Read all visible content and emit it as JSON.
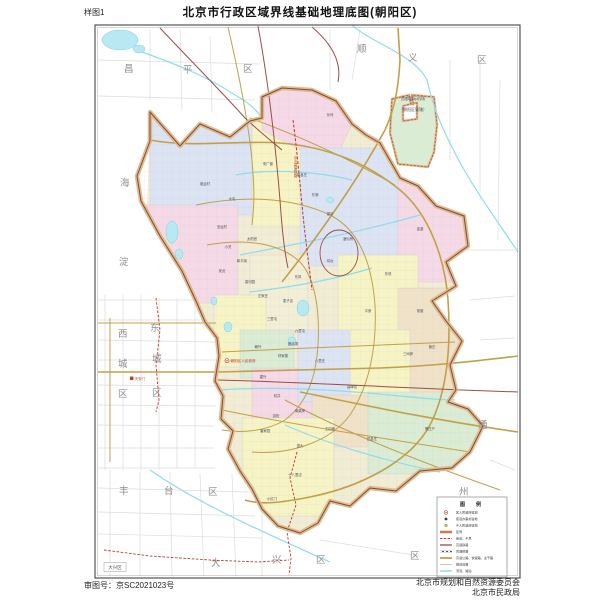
{
  "header": {
    "corner_label": "样图1",
    "title": "北京市行政区域界线基础地理底图(朝阳区)"
  },
  "footer": {
    "approval_number": "审图号：京SC2021023号",
    "credit_line1": "北京市规划和自然资源委员会",
    "credit_line2": "北京市民政局"
  },
  "colors": {
    "boundary_band": "#dbb98c",
    "boundary_line": "#8a4632",
    "district_red": "#c0392b",
    "water": "#8fdcec",
    "road_gold": "#c2a04a",
    "rail_darkred": "#9c4f44",
    "fill_pink": "#f5d9e6",
    "fill_yellow": "#f6f4c5",
    "fill_lavender": "#dce4f3",
    "fill_green": "#daecd4",
    "fill_cream": "#efe2c8"
  },
  "map": {
    "neighbor_labels": [
      {
        "t": "昌",
        "x": 124,
        "y": 72
      },
      {
        "t": "平",
        "x": 183,
        "y": 73
      },
      {
        "t": "区",
        "x": 243,
        "y": 72
      },
      {
        "t": "顺",
        "x": 357,
        "y": 52
      },
      {
        "t": "义",
        "x": 408,
        "y": 61
      },
      {
        "t": "区",
        "x": 477,
        "y": 63
      },
      {
        "t": "海",
        "x": 120,
        "y": 186
      },
      {
        "t": "淀",
        "x": 119,
        "y": 265
      },
      {
        "t": "西",
        "x": 118,
        "y": 337
      },
      {
        "t": "城",
        "x": 118,
        "y": 367
      },
      {
        "t": "区",
        "x": 118,
        "y": 397
      },
      {
        "t": "东",
        "x": 150,
        "y": 331
      },
      {
        "t": "城",
        "x": 152,
        "y": 362
      },
      {
        "t": "区",
        "x": 152,
        "y": 396
      },
      {
        "t": "丰",
        "x": 119,
        "y": 494
      },
      {
        "t": "台",
        "x": 164,
        "y": 494
      },
      {
        "t": "区",
        "x": 208,
        "y": 495
      },
      {
        "t": "大",
        "x": 211,
        "y": 566
      },
      {
        "t": "兴",
        "x": 272,
        "y": 563
      },
      {
        "t": "区",
        "x": 316,
        "y": 563
      },
      {
        "t": "通",
        "x": 478,
        "y": 428
      },
      {
        "t": "州",
        "x": 459,
        "y": 495
      },
      {
        "t": "区",
        "x": 410,
        "y": 559
      }
    ],
    "subdistrict_labels": [
      {
        "t": "奥运村",
        "x": 205,
        "y": 185
      },
      {
        "t": "大屯",
        "x": 232,
        "y": 200
      },
      {
        "t": "亚运村",
        "x": 222,
        "y": 228
      },
      {
        "t": "小关",
        "x": 228,
        "y": 248
      },
      {
        "t": "安贞",
        "x": 222,
        "y": 272
      },
      {
        "t": "和平街",
        "x": 242,
        "y": 262
      },
      {
        "t": "来广营",
        "x": 268,
        "y": 165
      },
      {
        "t": "崔各庄",
        "x": 302,
        "y": 176
      },
      {
        "t": "孙河",
        "x": 330,
        "y": 116
      },
      {
        "t": "望京",
        "x": 330,
        "y": 215
      },
      {
        "t": "东湖",
        "x": 315,
        "y": 196
      },
      {
        "t": "酒仙桥",
        "x": 348,
        "y": 240
      },
      {
        "t": "将台",
        "x": 330,
        "y": 262
      },
      {
        "t": "太阳宫",
        "x": 252,
        "y": 240
      },
      {
        "t": "香河园",
        "x": 250,
        "y": 283
      },
      {
        "t": "左家庄",
        "x": 263,
        "y": 297
      },
      {
        "t": "东风",
        "x": 298,
        "y": 278
      },
      {
        "t": "麦子店",
        "x": 288,
        "y": 302
      },
      {
        "t": "三里屯",
        "x": 272,
        "y": 320
      },
      {
        "t": "六里屯",
        "x": 300,
        "y": 332
      },
      {
        "t": "团结湖",
        "x": 293,
        "y": 345
      },
      {
        "t": "呼家楼",
        "x": 283,
        "y": 357
      },
      {
        "t": "朝外",
        "x": 258,
        "y": 348
      },
      {
        "t": "建外",
        "x": 263,
        "y": 378
      },
      {
        "t": "双井",
        "x": 277,
        "y": 397
      },
      {
        "t": "劲松",
        "x": 276,
        "y": 417
      },
      {
        "t": "潘家园",
        "x": 265,
        "y": 432
      },
      {
        "t": "垡头",
        "x": 300,
        "y": 447
      },
      {
        "t": "南磨房",
        "x": 300,
        "y": 412
      },
      {
        "t": "八里庄",
        "x": 320,
        "y": 362
      },
      {
        "t": "高碑店",
        "x": 352,
        "y": 388
      },
      {
        "t": "平房",
        "x": 368,
        "y": 312
      },
      {
        "t": "东坝",
        "x": 388,
        "y": 275
      },
      {
        "t": "金盏",
        "x": 420,
        "y": 230
      },
      {
        "t": "常营",
        "x": 420,
        "y": 312
      },
      {
        "t": "管庄",
        "x": 432,
        "y": 348
      },
      {
        "t": "三间房",
        "x": 408,
        "y": 355
      },
      {
        "t": "黑庄户",
        "x": 430,
        "y": 430
      },
      {
        "t": "豆各庄",
        "x": 372,
        "y": 440
      },
      {
        "t": "王四营",
        "x": 330,
        "y": 430
      },
      {
        "t": "十八里店",
        "x": 295,
        "y": 476
      },
      {
        "t": "小红门",
        "x": 272,
        "y": 500
      }
    ],
    "red_rail_label": {
      "text": "京沈高速铁路",
      "x": 296,
      "y": 156
    },
    "markers": {
      "district_gov": {
        "label": "朝阳区人民政府",
        "x": 232,
        "y": 362
      },
      "tiananmen": {
        "label": "天安门",
        "x": 136,
        "y": 380
      },
      "daxing_box": {
        "label": "大兴区",
        "x": 115,
        "y": 569
      },
      "enclave_line1": "首都国际机场",
      "enclave_line2": "（朝阳区管辖）"
    }
  },
  "legend": {
    "title": "图　例",
    "items": [
      {
        "symbol": "circle-red",
        "label": "区人民政府驻地"
      },
      {
        "symbol": "dot-dark",
        "label": "街道办事处驻地"
      },
      {
        "symbol": "dot-olive",
        "label": "乡人民政府驻地"
      },
      {
        "symbol": "line-red-thick",
        "label": "区界"
      },
      {
        "symbol": "line-red-dash",
        "label": "街道、乡界"
      },
      {
        "symbol": "line-darkred",
        "label": "高速铁路"
      },
      {
        "symbol": "line-rail",
        "label": "普通铁路"
      },
      {
        "symbol": "line-gold",
        "label": "高速公路、快速路、主干路"
      },
      {
        "symbol": "line-gray",
        "label": "规划道路"
      },
      {
        "symbol": "line-cyan",
        "label": "河流、湖泊"
      }
    ]
  }
}
